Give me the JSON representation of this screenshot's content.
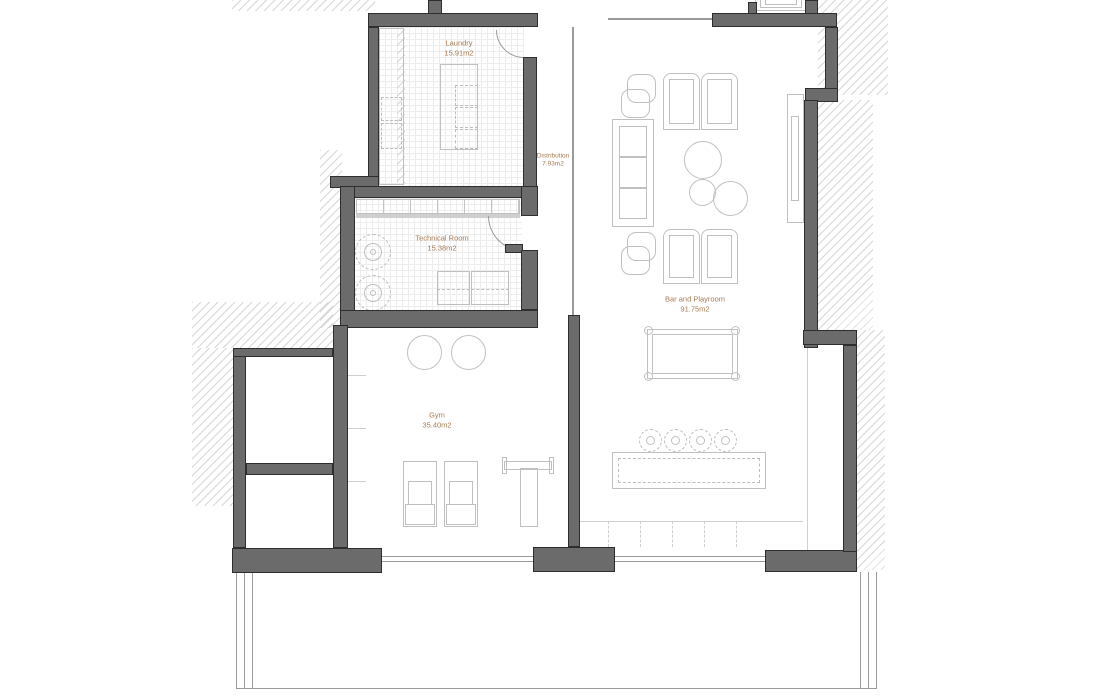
{
  "document": {
    "kind": "architectural floor plan",
    "background": "#ffffff"
  },
  "rooms": [
    {
      "id": "laundry",
      "name": "Laundry",
      "area": "15.91m2"
    },
    {
      "id": "distribution",
      "name": "Distribution",
      "area": "7.93m2"
    },
    {
      "id": "technical-room",
      "name": "Technical Room",
      "area": "15.38m2"
    },
    {
      "id": "gym",
      "name": "Gym",
      "area": "35.40m2"
    },
    {
      "id": "bar-playroom",
      "name": "Bar and Playroom",
      "area": "91.75m2"
    }
  ],
  "colors": {
    "wall": "#6b6b6b",
    "wall_outline": "#2e2e2e",
    "room_label": "#a87b52",
    "furniture_line": "#c0c0c0",
    "hatch_line": "#d7d7d7",
    "floor_grid": "#ededed"
  }
}
